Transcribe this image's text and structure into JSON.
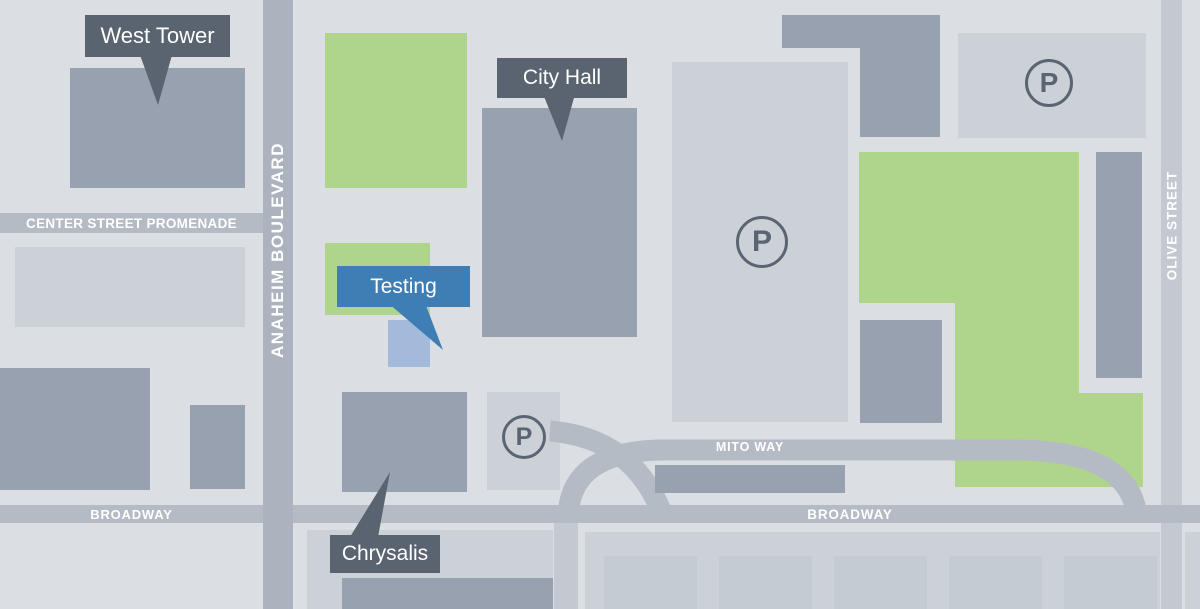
{
  "map_title": "Anaheim civic center area map",
  "streets": {
    "anaheim_boulevard": "ANAHEIM BOULEVARD",
    "center_street_promenade": "CENTER STREET PROMENADE",
    "broadway_left": "BROADWAY",
    "broadway_right": "BROADWAY",
    "mito_way": "MITO WAY",
    "olive_street": "OLIVE STREET"
  },
  "callouts": {
    "west_tower": "West Tower",
    "city_hall": "City Hall",
    "testing": "Testing",
    "chrysalis": "Chrysalis"
  },
  "parking": {
    "symbol": "P"
  },
  "colors": {
    "background": "#dbdee2",
    "street": "#b5bbc5",
    "street_anaheim": "#acb3bf",
    "street_olive": "#c3c8d1",
    "building": "#98a1af",
    "parking_lot": "#ccd1d8",
    "parking_stall": "#c5cbd3",
    "green_space": "#afd58c",
    "callout_dark": "#5a6370",
    "callout_blue": "#3f7eb5",
    "testing_building": "#a3badb",
    "parking_icon": "#5b6472",
    "street_text": "#ffffff"
  }
}
